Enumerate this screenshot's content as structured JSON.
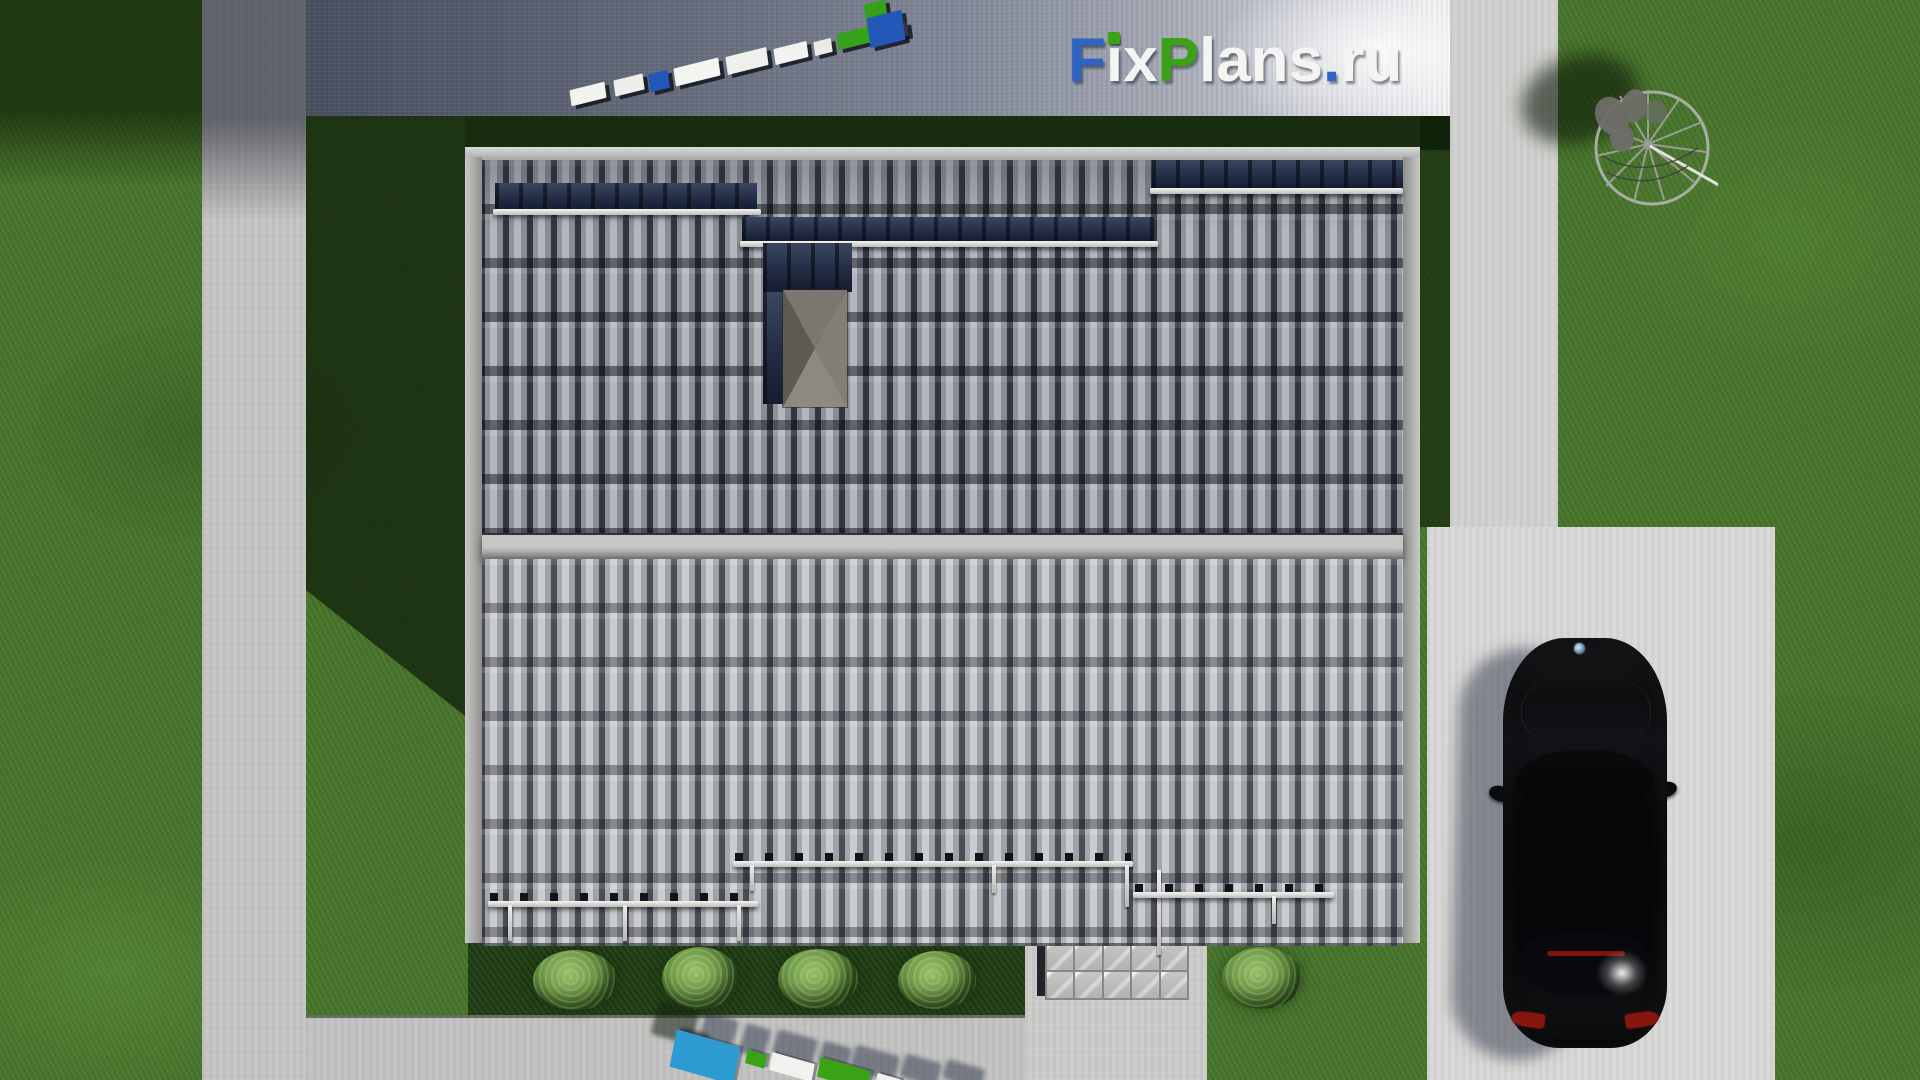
{
  "logo": {
    "text": "FixPlans.ru",
    "letters": [
      {
        "ch": "F",
        "color": "#2f63c6"
      },
      {
        "ch": "i",
        "color": "#f4f4f2"
      },
      {
        "ch": "x",
        "color": "#f4f4f2"
      },
      {
        "ch": "P",
        "color": "#3aa315"
      },
      {
        "ch": "l",
        "color": "#f4f4f2"
      },
      {
        "ch": "a",
        "color": "#f4f4f2"
      },
      {
        "ch": "n",
        "color": "#f4f4f2"
      },
      {
        "ch": "s",
        "color": "#f4f4f2"
      },
      {
        "ch": ".",
        "color": "#2f63c6"
      },
      {
        "ch": "r",
        "color": "#f4f4f2"
      },
      {
        "ch": "u",
        "color": "#f4f4f2"
      }
    ],
    "i_dot_color": "#3aa315"
  },
  "watermark_top": {
    "blocks": [
      {
        "color": "#f2f2ee"
      },
      {
        "color": "#eeeeea"
      },
      {
        "color": "#2458b8"
      },
      {
        "color": "#f4f4f0"
      },
      {
        "color": "#efefeb"
      },
      {
        "color": "#f2f2ee"
      },
      {
        "color": "#eaeae6"
      },
      {
        "color": "#35a11a"
      },
      {
        "color": "#f0f0ec"
      },
      {
        "color": "#2458b8"
      },
      {
        "color": "#35a11a"
      }
    ]
  },
  "watermark_bottom": {
    "blocks": [
      {
        "color": "#2e9ad2"
      },
      {
        "color": "#3aa315"
      },
      {
        "color": "#f2f2ee"
      },
      {
        "color": "#3aa315"
      },
      {
        "color": "#eeeeea"
      }
    ]
  },
  "scene": {
    "car_color": "#0a0b0c",
    "roof_upper_color": "#878b93",
    "roof_lower_color": "#9fa2a6",
    "grass_color": "#4a762e",
    "concrete_color": "#c4c4c2"
  }
}
